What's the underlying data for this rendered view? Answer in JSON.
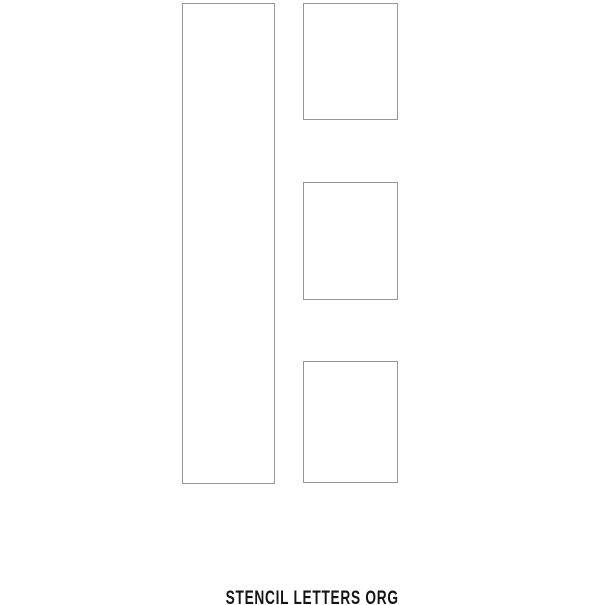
{
  "page": {
    "letter": "E",
    "description": "stencil-letter-template",
    "watermark": "STENCIL LETTERS ORG",
    "colors": {
      "background": "#ffffff",
      "panel_border": "#969696",
      "watermark_text": "#141414"
    }
  }
}
